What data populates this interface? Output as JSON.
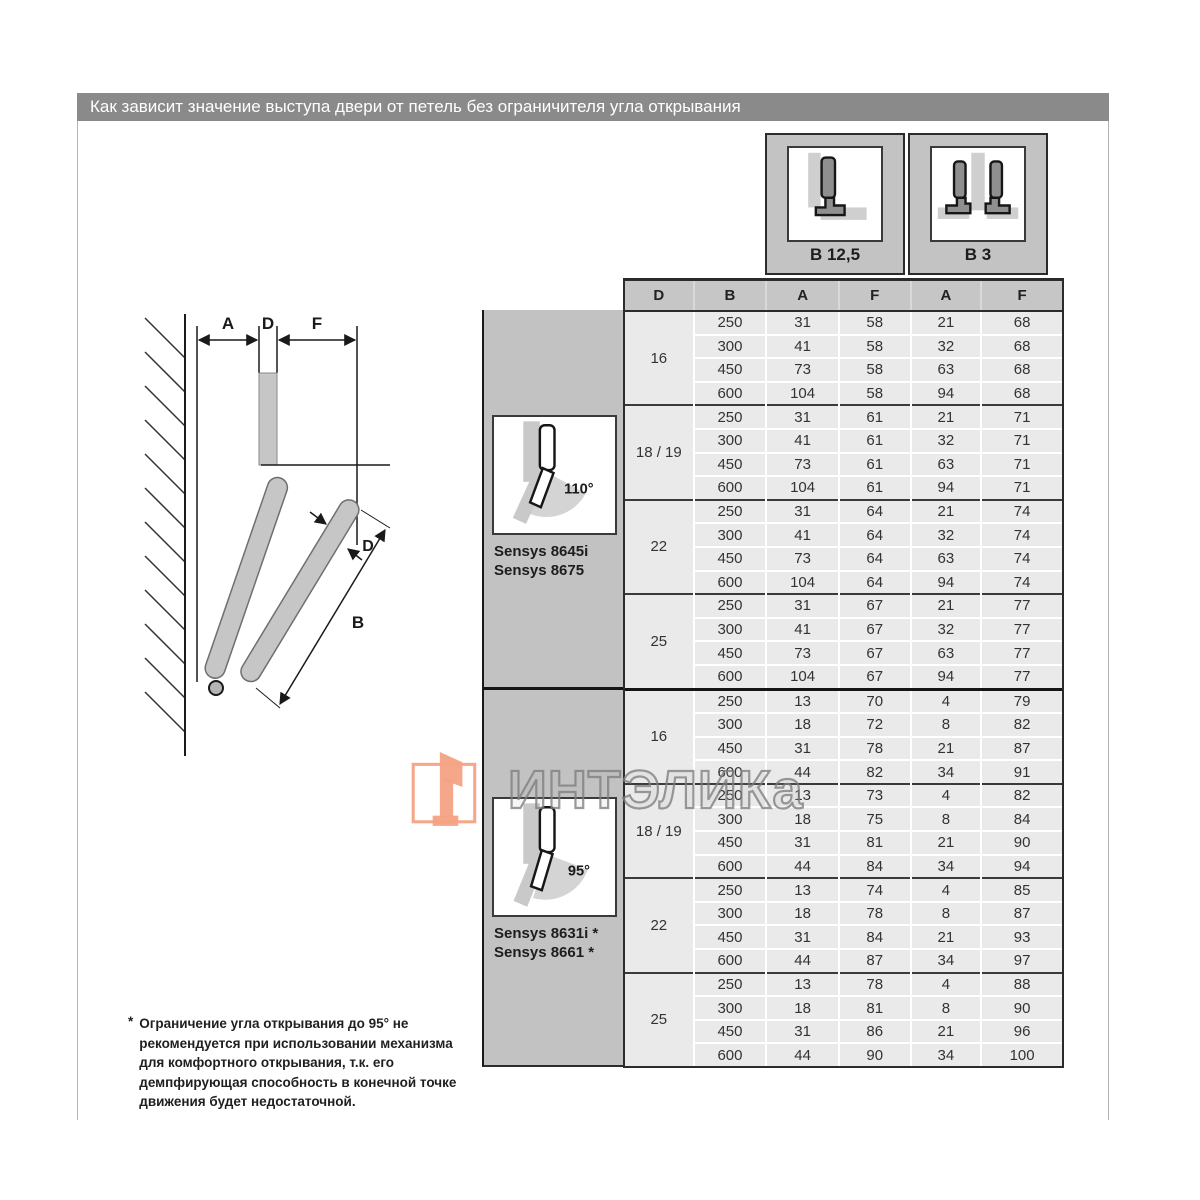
{
  "page": {
    "title": "Как зависит значение выступа двери от петель без ограничителя угла открывания"
  },
  "legend_boxes": [
    {
      "label": "B 12,5",
      "icon": "corner-mount-hinge-icon"
    },
    {
      "label": "B 3",
      "icon": "double-hinge-icon"
    }
  ],
  "diagram": {
    "labels": {
      "a": "A",
      "d_top": "D",
      "f": "F",
      "d_door": "D",
      "b": "B"
    }
  },
  "table": {
    "columns": [
      "D",
      "B",
      "A",
      "F",
      "A",
      "F"
    ],
    "sections": [
      {
        "hinge_angle": "110°",
        "models": [
          "Sensys 8645i",
          "Sensys 8675"
        ],
        "groups": [
          {
            "d": "16",
            "rows": [
              [
                "250",
                "31",
                "58",
                "21",
                "68"
              ],
              [
                "300",
                "41",
                "58",
                "32",
                "68"
              ],
              [
                "450",
                "73",
                "58",
                "63",
                "68"
              ],
              [
                "600",
                "104",
                "58",
                "94",
                "68"
              ]
            ]
          },
          {
            "d": "18 / 19",
            "rows": [
              [
                "250",
                "31",
                "61",
                "21",
                "71"
              ],
              [
                "300",
                "41",
                "61",
                "32",
                "71"
              ],
              [
                "450",
                "73",
                "61",
                "63",
                "71"
              ],
              [
                "600",
                "104",
                "61",
                "94",
                "71"
              ]
            ]
          },
          {
            "d": "22",
            "rows": [
              [
                "250",
                "31",
                "64",
                "21",
                "74"
              ],
              [
                "300",
                "41",
                "64",
                "32",
                "74"
              ],
              [
                "450",
                "73",
                "64",
                "63",
                "74"
              ],
              [
                "600",
                "104",
                "64",
                "94",
                "74"
              ]
            ]
          },
          {
            "d": "25",
            "rows": [
              [
                "250",
                "31",
                "67",
                "21",
                "77"
              ],
              [
                "300",
                "41",
                "67",
                "32",
                "77"
              ],
              [
                "450",
                "73",
                "67",
                "63",
                "77"
              ],
              [
                "600",
                "104",
                "67",
                "94",
                "77"
              ]
            ]
          }
        ]
      },
      {
        "hinge_angle": "95°",
        "models": [
          "Sensys 8631i *",
          "Sensys 8661 *"
        ],
        "groups": [
          {
            "d": "16",
            "rows": [
              [
                "250",
                "13",
                "70",
                "4",
                "79"
              ],
              [
                "300",
                "18",
                "72",
                "8",
                "82"
              ],
              [
                "450",
                "31",
                "78",
                "21",
                "87"
              ],
              [
                "600",
                "44",
                "82",
                "34",
                "91"
              ]
            ]
          },
          {
            "d": "18 / 19",
            "rows": [
              [
                "250",
                "13",
                "73",
                "4",
                "82"
              ],
              [
                "300",
                "18",
                "75",
                "8",
                "84"
              ],
              [
                "450",
                "31",
                "81",
                "21",
                "90"
              ],
              [
                "600",
                "44",
                "84",
                "34",
                "94"
              ]
            ]
          },
          {
            "d": "22",
            "rows": [
              [
                "250",
                "13",
                "74",
                "4",
                "85"
              ],
              [
                "300",
                "18",
                "78",
                "8",
                "87"
              ],
              [
                "450",
                "31",
                "84",
                "21",
                "93"
              ],
              [
                "600",
                "44",
                "87",
                "34",
                "97"
              ]
            ]
          },
          {
            "d": "25",
            "rows": [
              [
                "250",
                "13",
                "78",
                "4",
                "88"
              ],
              [
                "300",
                "18",
                "81",
                "8",
                "90"
              ],
              [
                "450",
                "31",
                "86",
                "21",
                "96"
              ],
              [
                "600",
                "44",
                "90",
                "34",
                "100"
              ]
            ]
          }
        ]
      }
    ]
  },
  "footnote": {
    "marker": "*",
    "text": "Ограничение угла открывания до 95° не рекомендуется при использовании механизма для комфортного открывания, т.к. его демпфирующая способность в конечной точке движения будет недостаточной."
  },
  "watermark": {
    "text": "ИНТЭЛИКа",
    "accent_color": "#f4a284"
  },
  "colors": {
    "title_bar": "#8a8a8a",
    "table_header": "#c6c6c6",
    "table_cell": "#eaeaea",
    "sidebar": "#c2c2c2",
    "watermark_accent": "#f4a284"
  }
}
